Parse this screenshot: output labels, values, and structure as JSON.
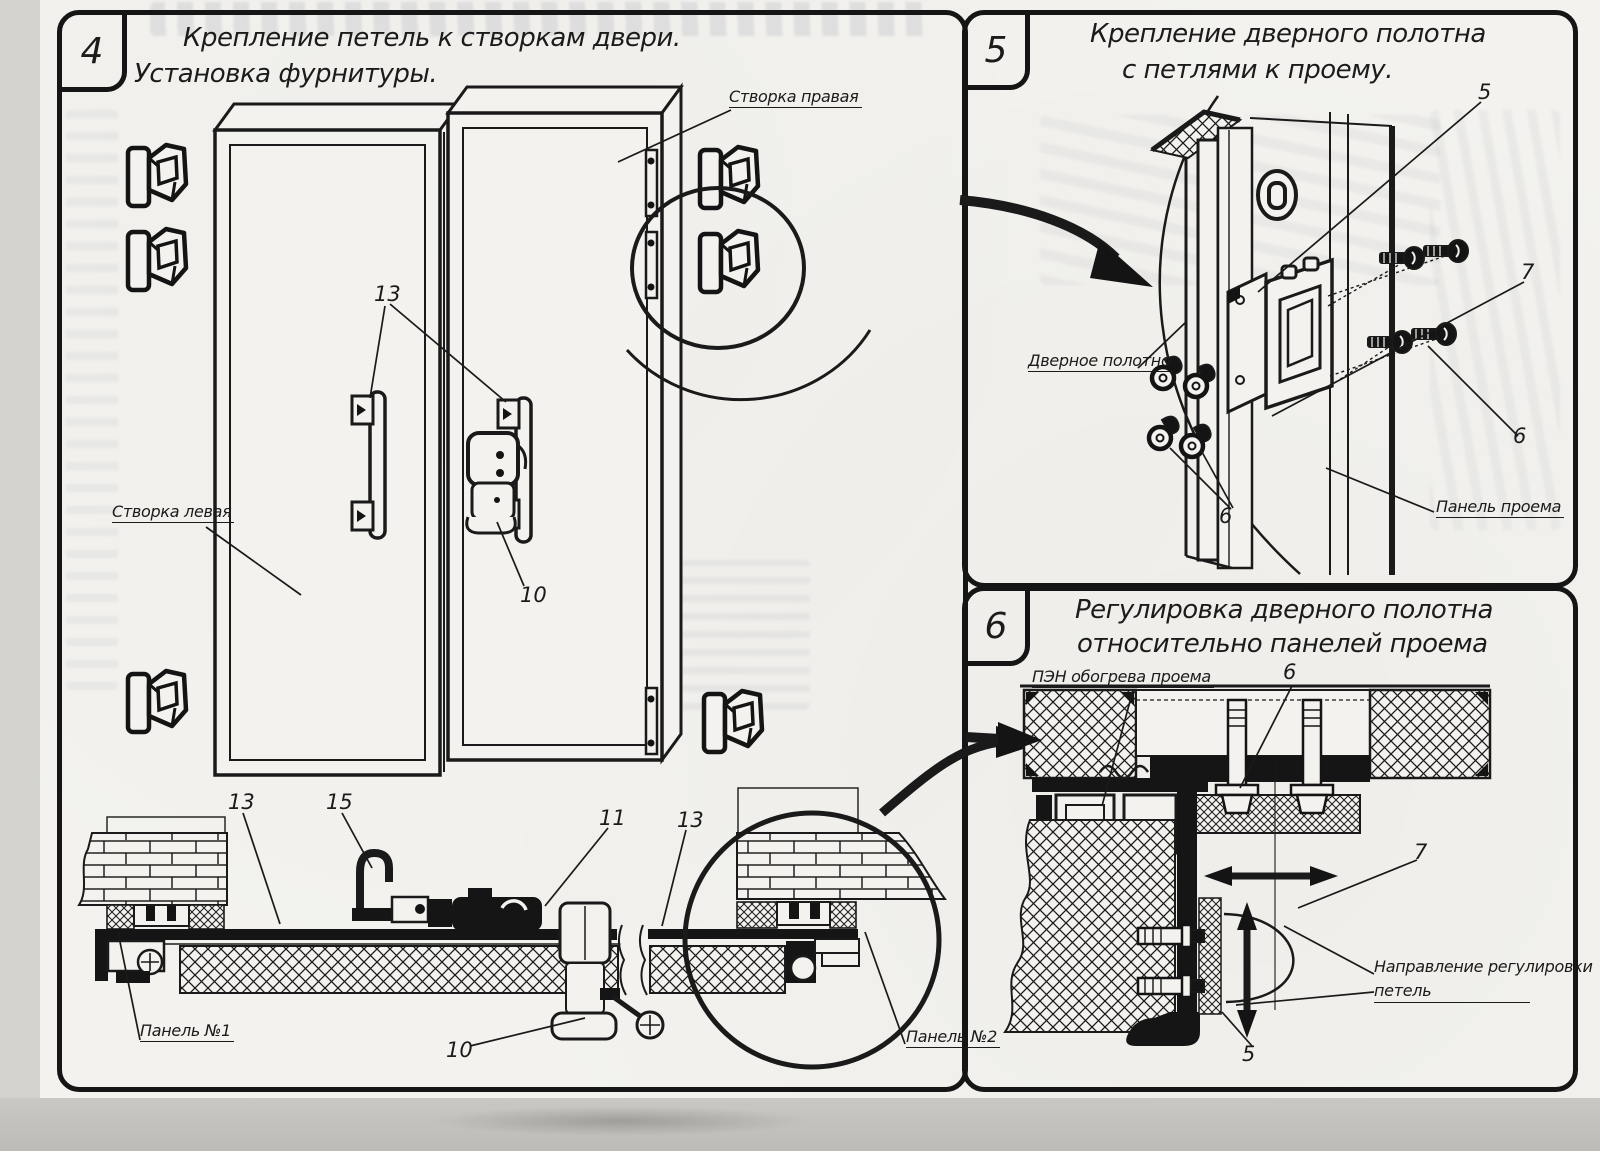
{
  "panels": {
    "p4": {
      "number": "4",
      "title1": "Крепление петель к створкам двери.",
      "title2": "Установка фурнитуры.",
      "labels": {
        "right_leaf": "Створка правая",
        "left_leaf": "Створка левая",
        "panel1": "Панель №1",
        "panel2": "Панель №2"
      },
      "callouts": {
        "c13_handles": "13",
        "c10_latch": "10",
        "c13_section_left": "13",
        "c15_hook": "15",
        "c11_clamp": "11",
        "c13_section_right": "13",
        "c10_section": "10"
      }
    },
    "p5": {
      "number": "5",
      "title1": "Крепление дверного полотна",
      "title2": "с петлями к проему.",
      "labels": {
        "door_leaf": "Дверное полотно",
        "opening_panel": "Панель проема"
      },
      "callouts": {
        "c5_hinge": "5",
        "c7_hinge": "7",
        "c6_screws_right": "6",
        "c6_washers_left": "6"
      }
    },
    "p6": {
      "number": "6",
      "title1": "Регулировка дверного полотна",
      "title2": "относительно панелей проема",
      "labels": {
        "heater": "ПЭН обогрева проема",
        "direction_line1": "Направление регулировки",
        "direction_line2": "петель"
      },
      "callouts": {
        "c6_bolts": "6",
        "c7_edge": "7",
        "c5_hinge": "5"
      }
    },
    "ink_color": "#1a1a1a",
    "paper_color": "#f3f2ee"
  }
}
